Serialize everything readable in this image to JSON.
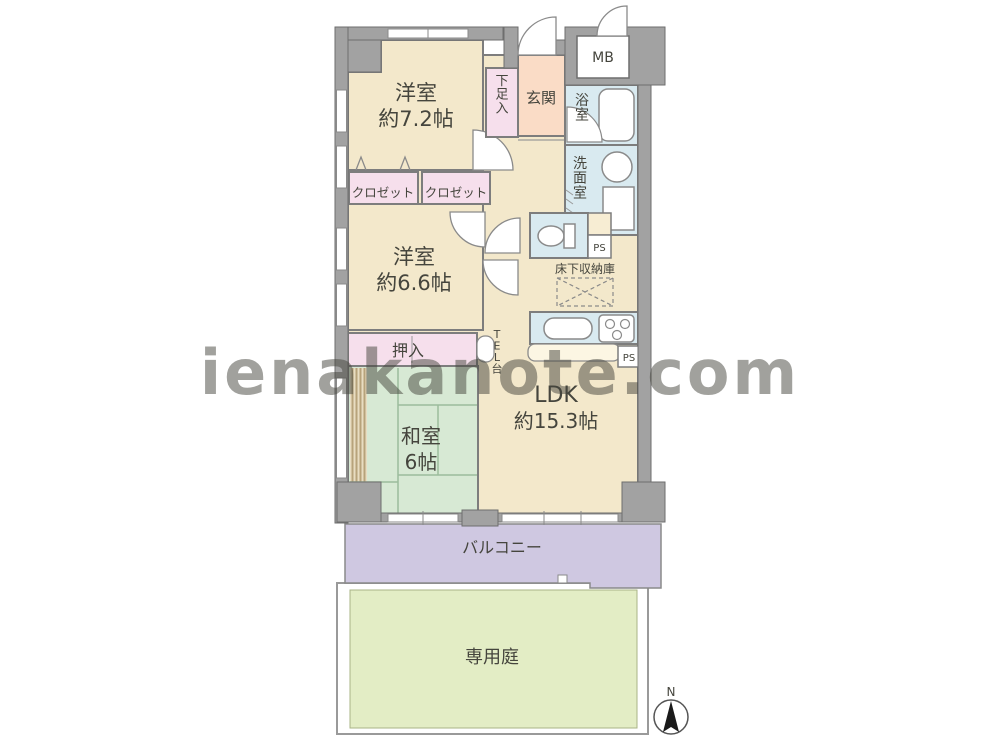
{
  "watermark": "ienakanote.com",
  "compass": {
    "north_label": "N"
  },
  "rooms": {
    "western_room_1": {
      "name": "洋室",
      "size": "約7.2帖"
    },
    "western_room_2": {
      "name": "洋室",
      "size": "約6.6帖"
    },
    "japanese_room": {
      "name": "和室",
      "size": "6帖"
    },
    "ldk": {
      "name": "LDK",
      "size": "約15.3帖"
    },
    "closet_left": {
      "label": "クロゼット"
    },
    "closet_right": {
      "label": "クロゼット"
    },
    "oshiire": {
      "label": "押入"
    },
    "shoe_cabinet": {
      "label": "下足入"
    },
    "entrance": {
      "label": "玄関"
    },
    "bathroom": {
      "label": "浴室"
    },
    "washroom": {
      "label": "洗面室"
    },
    "meter_box": {
      "label": "MB"
    },
    "pipe_space_toilet": {
      "label": "PS"
    },
    "pipe_space_kitchen": {
      "label": "PS"
    },
    "underfloor_storage": {
      "label": "床下収納庫"
    },
    "tel_stand": {
      "label": "TEL台"
    },
    "balcony": {
      "label": "バルコニー"
    },
    "private_garden": {
      "label": "専用庭"
    }
  },
  "colors": {
    "wall_gray": "#a2a2a2",
    "room_beige": "#f3e8cb",
    "closet_pink": "#f6dfec",
    "entrance_peach": "#fadcc6",
    "wet_area_blue": "#d9eaf0",
    "tatami_green": "#d7e9d4",
    "balcony_lavender": "#cfc8e1",
    "garden_green": "#e3edc5",
    "watermark_gray": "#c2c2c2"
  }
}
